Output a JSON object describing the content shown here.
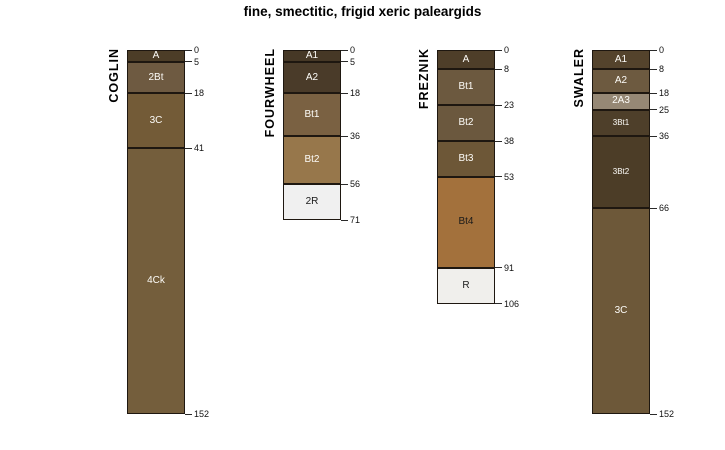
{
  "chart_data": {
    "type": "bar",
    "subtype": "soil-profile-depth-columns",
    "title": "fine, smectitic, frigid xeric paleargids",
    "ylim": [
      0,
      152
    ],
    "grid": false,
    "edge_color": "#1e1710",
    "profiles": [
      {
        "name": "COGLIN",
        "horizons": [
          {
            "label": "A",
            "top": 0,
            "bottom": 5,
            "color": "#4c3d27",
            "text_color": "#fdfcf8"
          },
          {
            "label": "2Bt",
            "top": 5,
            "bottom": 18,
            "color": "#6e5a41",
            "text_color": "#fdfcf8"
          },
          {
            "label": "3C",
            "top": 18,
            "bottom": 41,
            "color": "#735b37",
            "text_color": "#fdfcf8"
          },
          {
            "label": "4Ck",
            "top": 41,
            "bottom": 152,
            "color": "#745e3c",
            "text_color": "#fdfcf8"
          }
        ]
      },
      {
        "name": "FOURWHEEL",
        "horizons": [
          {
            "label": "A1",
            "top": 0,
            "bottom": 5,
            "color": "#463826",
            "text_color": "#fdfcf8"
          },
          {
            "label": "A2",
            "top": 5,
            "bottom": 18,
            "color": "#4a3b29",
            "text_color": "#fdfcf8"
          },
          {
            "label": "Bt1",
            "top": 18,
            "bottom": 36,
            "color": "#7a6142",
            "text_color": "#fdfcf8"
          },
          {
            "label": "Bt2",
            "top": 36,
            "bottom": 56,
            "color": "#97774b",
            "text_color": "#fdfcf8"
          },
          {
            "label": "2R",
            "top": 56,
            "bottom": 71,
            "color": "#f0f0f0",
            "text_color": "#1a1a1a"
          }
        ]
      },
      {
        "name": "FREZNIK",
        "horizons": [
          {
            "label": "A",
            "top": 0,
            "bottom": 8,
            "color": "#4e3e29",
            "text_color": "#fdfcf8"
          },
          {
            "label": "Bt1",
            "top": 8,
            "bottom": 23,
            "color": "#6c593f",
            "text_color": "#fdfcf8"
          },
          {
            "label": "Bt2",
            "top": 23,
            "bottom": 38,
            "color": "#6b583e",
            "text_color": "#fdfcf8"
          },
          {
            "label": "Bt3",
            "top": 38,
            "bottom": 53,
            "color": "#6d5737",
            "text_color": "#fdfcf8"
          },
          {
            "label": "Bt4",
            "top": 53,
            "bottom": 91,
            "color": "#a3713c",
            "text_color": "#1a1a1a"
          },
          {
            "label": "R",
            "top": 91,
            "bottom": 106,
            "color": "#f0efec",
            "text_color": "#1a1a1a"
          }
        ]
      },
      {
        "name": "SWALER",
        "horizons": [
          {
            "label": "A1",
            "top": 0,
            "bottom": 8,
            "color": "#54432c",
            "text_color": "#fdfcf8"
          },
          {
            "label": "A2",
            "top": 8,
            "bottom": 18,
            "color": "#6d5a40",
            "text_color": "#fdfcf8"
          },
          {
            "label": "2A3",
            "top": 18,
            "bottom": 25,
            "color": "#968875",
            "text_color": "#fdfcf8"
          },
          {
            "label": "3Bt1",
            "top": 25,
            "bottom": 36,
            "color": "#4e3f2a",
            "text_color": "#fdfcf8",
            "small_label": true
          },
          {
            "label": "3Bt2",
            "top": 36,
            "bottom": 66,
            "color": "#4c3d27",
            "text_color": "#fdfcf8",
            "small_label": true
          },
          {
            "label": "3C",
            "top": 66,
            "bottom": 152,
            "color": "#6d5839",
            "text_color": "#fdfcf8"
          }
        ]
      }
    ]
  }
}
